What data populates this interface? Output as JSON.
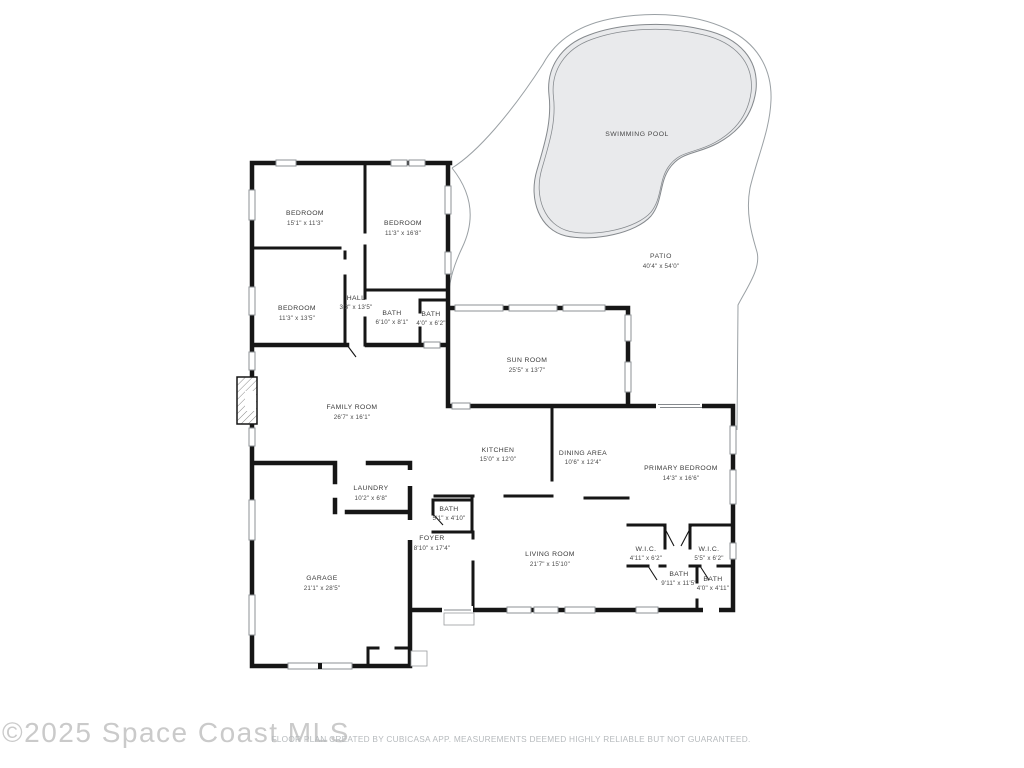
{
  "watermark": {
    "text": "©2025 Space Coast MLS",
    "color": "#cacaca"
  },
  "footer": {
    "text": "FLOOR PLAN CREATED BY CUBICASA APP. MEASUREMENTS DEEMED HIGHLY RELIABLE BUT NOT GUARANTEED.",
    "color": "#b6babd"
  },
  "outdoor": {
    "pool": {
      "label": "SWIMMING POOL",
      "fill": "#e9eaec",
      "outline": "#85898d"
    },
    "patio": {
      "label": "PATIO",
      "dims": "40'4\" x 54'0\"",
      "outline": "#9aa0a4"
    }
  },
  "colors": {
    "walls": "#161616",
    "window_frame": "#8d9296"
  },
  "rooms": [
    {
      "id": "bedroom-1",
      "name": "BEDROOM",
      "dims": "15'1\" x 11'3\""
    },
    {
      "id": "bedroom-2",
      "name": "BEDROOM",
      "dims": "11'3\" x 16'8\""
    },
    {
      "id": "bedroom-3",
      "name": "BEDROOM",
      "dims": "11'3\" x 13'5\""
    },
    {
      "id": "hall",
      "name": "HALL",
      "dims": "3'3\" x 13'5\""
    },
    {
      "id": "bath-1",
      "name": "BATH",
      "dims": "6'10\" x 8'1\""
    },
    {
      "id": "bath-2",
      "name": "BATH",
      "dims": "4'0\" x 6'2\""
    },
    {
      "id": "sun-room",
      "name": "SUN ROOM",
      "dims": "25'5\" x 13'7\""
    },
    {
      "id": "family-room",
      "name": "FAMILY ROOM",
      "dims": "26'7\" x 16'1\""
    },
    {
      "id": "kitchen",
      "name": "KITCHEN",
      "dims": "15'0\" x 12'0\""
    },
    {
      "id": "dining-area",
      "name": "DINING AREA",
      "dims": "10'6\" x 12'4\""
    },
    {
      "id": "primary-bedroom",
      "name": "PRIMARY BEDROOM",
      "dims": "14'3\" x 16'6\""
    },
    {
      "id": "laundry",
      "name": "LAUNDRY",
      "dims": "10'2\" x 6'8\""
    },
    {
      "id": "bath-3",
      "name": "BATH",
      "dims": "5'1\" x 4'10\""
    },
    {
      "id": "foyer",
      "name": "FOYER",
      "dims": "8'10\" x 17'4\""
    },
    {
      "id": "living-room",
      "name": "LIVING ROOM",
      "dims": "21'7\" x 15'10\""
    },
    {
      "id": "wic-1",
      "name": "W.I.C.",
      "dims": "4'11\" x 6'2\""
    },
    {
      "id": "wic-2",
      "name": "W.I.C.",
      "dims": "5'5\" x 6'2\""
    },
    {
      "id": "bath-4",
      "name": "BATH",
      "dims": "9'11\" x 11'5\""
    },
    {
      "id": "bath-5",
      "name": "BATH",
      "dims": "4'0\" x 4'11\""
    },
    {
      "id": "garage",
      "name": "GARAGE",
      "dims": "21'1\" x 28'5\""
    }
  ]
}
